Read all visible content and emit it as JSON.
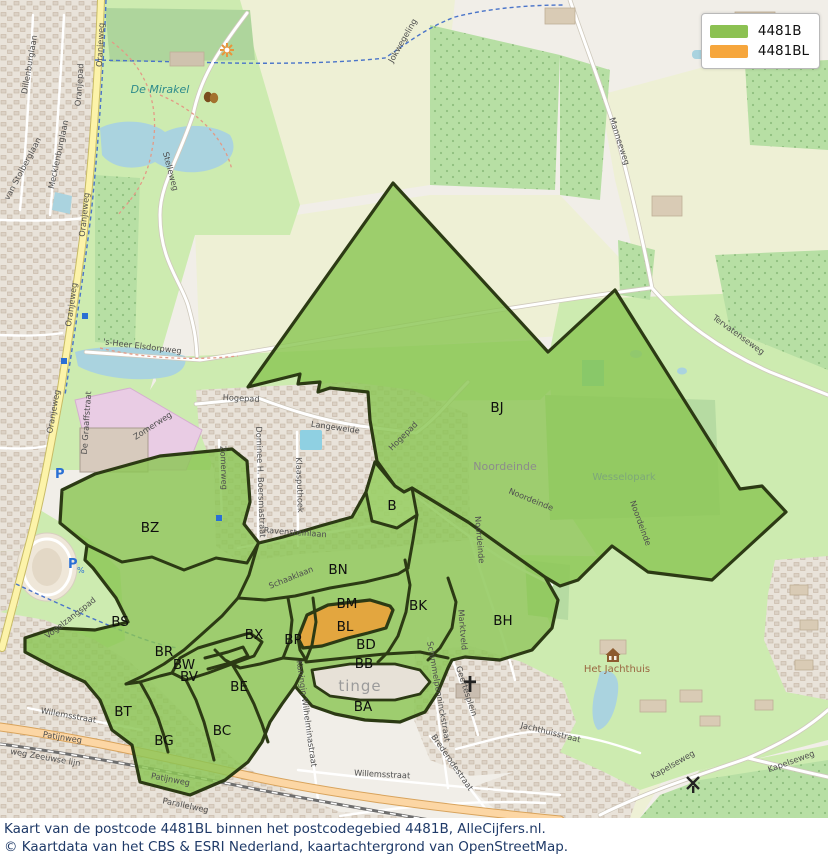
{
  "legend": {
    "items": [
      {
        "label": "4481B",
        "color": "#8cc152"
      },
      {
        "label": "4481BL",
        "color": "#f6a63c"
      }
    ]
  },
  "caption": {
    "line1": "Kaart van de postcode 4481BL binnen het postcodegebied 4481B, AlleCijfers.nl.",
    "line2": "© Kaartdata van het CBS & ESRI Nederland, kaartachtergrond van OpenStreetMap."
  },
  "map": {
    "colors": {
      "postcode_green": "#8bc654",
      "postcode_orange": "#e7a33c",
      "border": "#2c3a14"
    },
    "zones": [
      {
        "id": "area-4481B-cluster",
        "cls": "green",
        "pts": "62,490 95,474 160,456 232,449 247,461 250,502 244,524 259,543 283,537 320,526 352,517 366,492 375,462 395,486 404,492 412,488 468,522 545,577 558,600 552,628 532,650 500,660 465,657 452,660 448,668 438,692 425,712 400,722 365,720 335,714 312,706 300,692 295,686 282,704 270,722 262,742 248,762 225,780 190,795 140,782 132,745 112,730 100,700 85,682 55,668 25,652 25,638 55,628 95,630 128,622 116,598 93,568 85,560 87,545 60,523"
      },
      {
        "id": "area-4481B-BJ",
        "cls": "green",
        "pts": "393,183 548,352 615,290 740,489 762,486 786,512 712,580 648,572 612,546 578,580 560,586 545,577 468,522 412,488 404,492 395,486 377,461 370,420 368,392 330,388 318,392 320,382 298,384 300,374 248,387"
      },
      {
        "id": "area-4481B-B",
        "cls": "green-light",
        "pts": "366,492 375,462 395,486 404,492 412,488 417,515 397,528 372,521"
      },
      {
        "id": "area-kloetinge-gap",
        "cls": "hole",
        "pts": "312,670 350,664 395,664 420,670 430,682 420,694 395,700 360,700 330,696 315,686"
      },
      {
        "id": "area-4481BL",
        "cls": "orange",
        "pts": "298,638 307,615 328,605 370,600 390,606 393,610 386,628 368,633 348,638 322,646 303,648"
      }
    ],
    "internal_borders": [
      "87,545 122,562 152,557 184,570 216,558 247,563 258,544",
      "258,544 249,575 238,598 222,616 202,634 184,650 164,664 143,676 126,684",
      "238,598 265,600 295,596 330,588 365,582 398,574 408,568",
      "288,598 292,620 290,640 283,658",
      "313,598 316,622 312,645 306,660",
      "283,658 260,664 240,668 225,660 215,650",
      "283,658 306,660",
      "306,660 300,650 298,638",
      "405,560 410,585 406,612 398,636 388,652 378,662",
      "306,662 345,658 385,654 420,652 448,658",
      "300,660 302,672 298,680 295,686",
      "198,648 225,640 250,633 262,642 254,656 232,664 208,673 186,680 172,673 180,658 198,648",
      "205,658 228,652 243,647 248,656 230,663 208,669",
      "126,684 140,682 160,676 172,673",
      "140,682 150,700 158,718 164,736 168,752",
      "186,680 196,700 204,722 210,744 214,760",
      "232,664 244,684 254,704 262,724 268,742",
      "448,578 456,602 452,628 440,648 428,660",
      "417,515 413,540 408,568"
    ],
    "area_labels": [
      {
        "t": "BJ",
        "x": 497,
        "y": 412
      },
      {
        "t": "B",
        "x": 392,
        "y": 510
      },
      {
        "t": "BZ",
        "x": 150,
        "y": 532
      },
      {
        "t": "BS",
        "x": 120,
        "y": 626
      },
      {
        "t": "BN",
        "x": 338,
        "y": 574
      },
      {
        "t": "BM",
        "x": 347,
        "y": 608
      },
      {
        "t": "BL",
        "x": 345,
        "y": 631
      },
      {
        "t": "BK",
        "x": 418,
        "y": 610
      },
      {
        "t": "BD",
        "x": 366,
        "y": 649
      },
      {
        "t": "BB",
        "x": 364,
        "y": 668
      },
      {
        "t": "BH",
        "x": 503,
        "y": 625
      },
      {
        "t": "BX",
        "x": 254,
        "y": 639
      },
      {
        "t": "BP",
        "x": 293,
        "y": 644
      },
      {
        "t": "BR",
        "x": 164,
        "y": 656
      },
      {
        "t": "BW",
        "x": 184,
        "y": 669
      },
      {
        "t": "BV",
        "x": 189,
        "y": 681
      },
      {
        "t": "BE",
        "x": 239,
        "y": 691
      },
      {
        "t": "BT",
        "x": 123,
        "y": 716
      },
      {
        "t": "BG",
        "x": 164,
        "y": 745
      },
      {
        "t": "BC",
        "x": 222,
        "y": 735
      },
      {
        "t": "BA",
        "x": 363,
        "y": 711
      }
    ],
    "street_labels": [
      {
        "t": "Oranjeweg",
        "x": 103,
        "y": 45,
        "r": -87
      },
      {
        "t": "Oranjeweg",
        "x": 87,
        "y": 215,
        "r": -84
      },
      {
        "t": "Oranjeweg",
        "x": 74,
        "y": 305,
        "r": -82
      },
      {
        "t": "Oranjeweg",
        "x": 56,
        "y": 412,
        "r": -80
      },
      {
        "t": "Oranjepad",
        "x": 82,
        "y": 85,
        "r": -86
      },
      {
        "t": "Dillenburglaan",
        "x": 32,
        "y": 65,
        "r": -80
      },
      {
        "t": "Mecklenburglaan",
        "x": 61,
        "y": 155,
        "r": -78
      },
      {
        "t": "van Stolberglaan",
        "x": 25,
        "y": 170,
        "r": -62
      },
      {
        "t": "De Graaffstraat",
        "x": 89,
        "y": 423,
        "r": -86
      },
      {
        "t": "'s-Heer Elsdorpweg",
        "x": 142,
        "y": 349,
        "r": 7
      },
      {
        "t": "Stelleweg",
        "x": 168,
        "y": 172,
        "r": 75
      },
      {
        "t": "Zomerweg",
        "x": 154,
        "y": 428,
        "r": -33
      },
      {
        "t": "Zomerweg",
        "x": 221,
        "y": 468,
        "r": 88
      },
      {
        "t": "Jokwegeling",
        "x": 405,
        "y": 42,
        "r": -60
      },
      {
        "t": "Manneeweg",
        "x": 617,
        "y": 142,
        "r": 72
      },
      {
        "t": "Tervatenseweg",
        "x": 737,
        "y": 337,
        "r": 36
      },
      {
        "t": "Hogepad",
        "x": 241,
        "y": 401,
        "r": 3
      },
      {
        "t": "Langeweide",
        "x": 335,
        "y": 430,
        "r": 8
      },
      {
        "t": "Hogepad",
        "x": 405,
        "y": 438,
        "r": -45
      },
      {
        "t": "Ravensteinlaan",
        "x": 295,
        "y": 535,
        "r": 4
      },
      {
        "t": "Dominee H. Boersmastraat",
        "x": 258,
        "y": 482,
        "r": 88
      },
      {
        "t": "Klaasputhoek",
        "x": 297,
        "y": 485,
        "r": 88
      },
      {
        "t": "Schaaklaan",
        "x": 292,
        "y": 580,
        "r": -22
      },
      {
        "t": "Noordeinde",
        "x": 477,
        "y": 540,
        "r": 85
      },
      {
        "t": "Noordeinde",
        "x": 530,
        "y": 502,
        "r": 22
      },
      {
        "t": "Noordeinde",
        "x": 638,
        "y": 524,
        "r": 70
      },
      {
        "t": "Marktveld",
        "x": 460,
        "y": 630,
        "r": 85
      },
      {
        "t": "Vogelzangspad",
        "x": 72,
        "y": 620,
        "r": -38
      },
      {
        "t": "Patijnweg",
        "x": 62,
        "y": 740,
        "r": 9
      },
      {
        "t": "Patijnweg",
        "x": 170,
        "y": 782,
        "r": 11
      },
      {
        "t": "weg Zeeuwse lijn",
        "x": 45,
        "y": 760,
        "r": 10
      },
      {
        "t": "Parallelweg",
        "x": 185,
        "y": 808,
        "r": 12
      },
      {
        "t": "Willemsstraat",
        "x": 68,
        "y": 718,
        "r": 10
      },
      {
        "t": "Willemsstraat",
        "x": 382,
        "y": 777,
        "r": 3
      },
      {
        "t": "Koningin Wilhelminastraat",
        "x": 304,
        "y": 714,
        "r": 82
      },
      {
        "t": "Schimmelpenninckstraat",
        "x": 436,
        "y": 692,
        "r": 80
      },
      {
        "t": "Geertesplein",
        "x": 464,
        "y": 692,
        "r": 72
      },
      {
        "t": "Brederodestraat",
        "x": 450,
        "y": 764,
        "r": 55
      },
      {
        "t": "Jachthuisstraat",
        "x": 550,
        "y": 735,
        "r": 14
      },
      {
        "t": "Kapelseweg",
        "x": 674,
        "y": 767,
        "r": -30
      },
      {
        "t": "Kapelseweg",
        "x": 792,
        "y": 764,
        "r": -20
      }
    ],
    "place_labels": [
      {
        "t": "De Mirakel",
        "x": 160,
        "y": 93,
        "c": "water-name"
      },
      {
        "t": "Noordeinde",
        "x": 505,
        "y": 470,
        "c": "place"
      },
      {
        "t": "Wesselopark",
        "x": 624,
        "y": 480,
        "c": "park-name"
      },
      {
        "t": "Het Jachthuis",
        "x": 617,
        "y": 672,
        "c": "poi-name"
      },
      {
        "t": "tinge",
        "x": 360,
        "y": 691,
        "c": "place-big"
      }
    ],
    "icons": [
      {
        "type": "church",
        "name": "church-icon",
        "x": 464,
        "y": 682
      },
      {
        "type": "windmill",
        "name": "windmill-icon",
        "x": 687,
        "y": 777
      },
      {
        "type": "house",
        "name": "heritage-house-icon",
        "x": 607,
        "y": 649
      },
      {
        "type": "masks",
        "name": "theater-masks-icon",
        "x": 204,
        "y": 91
      },
      {
        "type": "sun",
        "name": "attraction-icon",
        "x": 221,
        "y": 44
      },
      {
        "type": "p",
        "name": "parking-icon",
        "x": 55,
        "y": 466
      },
      {
        "type": "pfee",
        "name": "paid-parking-icon",
        "x": 68,
        "y": 556
      },
      {
        "type": "bus",
        "name": "bus-stop-icon",
        "x": 216,
        "y": 515
      },
      {
        "type": "bus",
        "name": "bus-stop-icon",
        "x": 82,
        "y": 313
      },
      {
        "type": "bus",
        "name": "bus-stop-icon",
        "x": 61,
        "y": 358
      }
    ]
  }
}
